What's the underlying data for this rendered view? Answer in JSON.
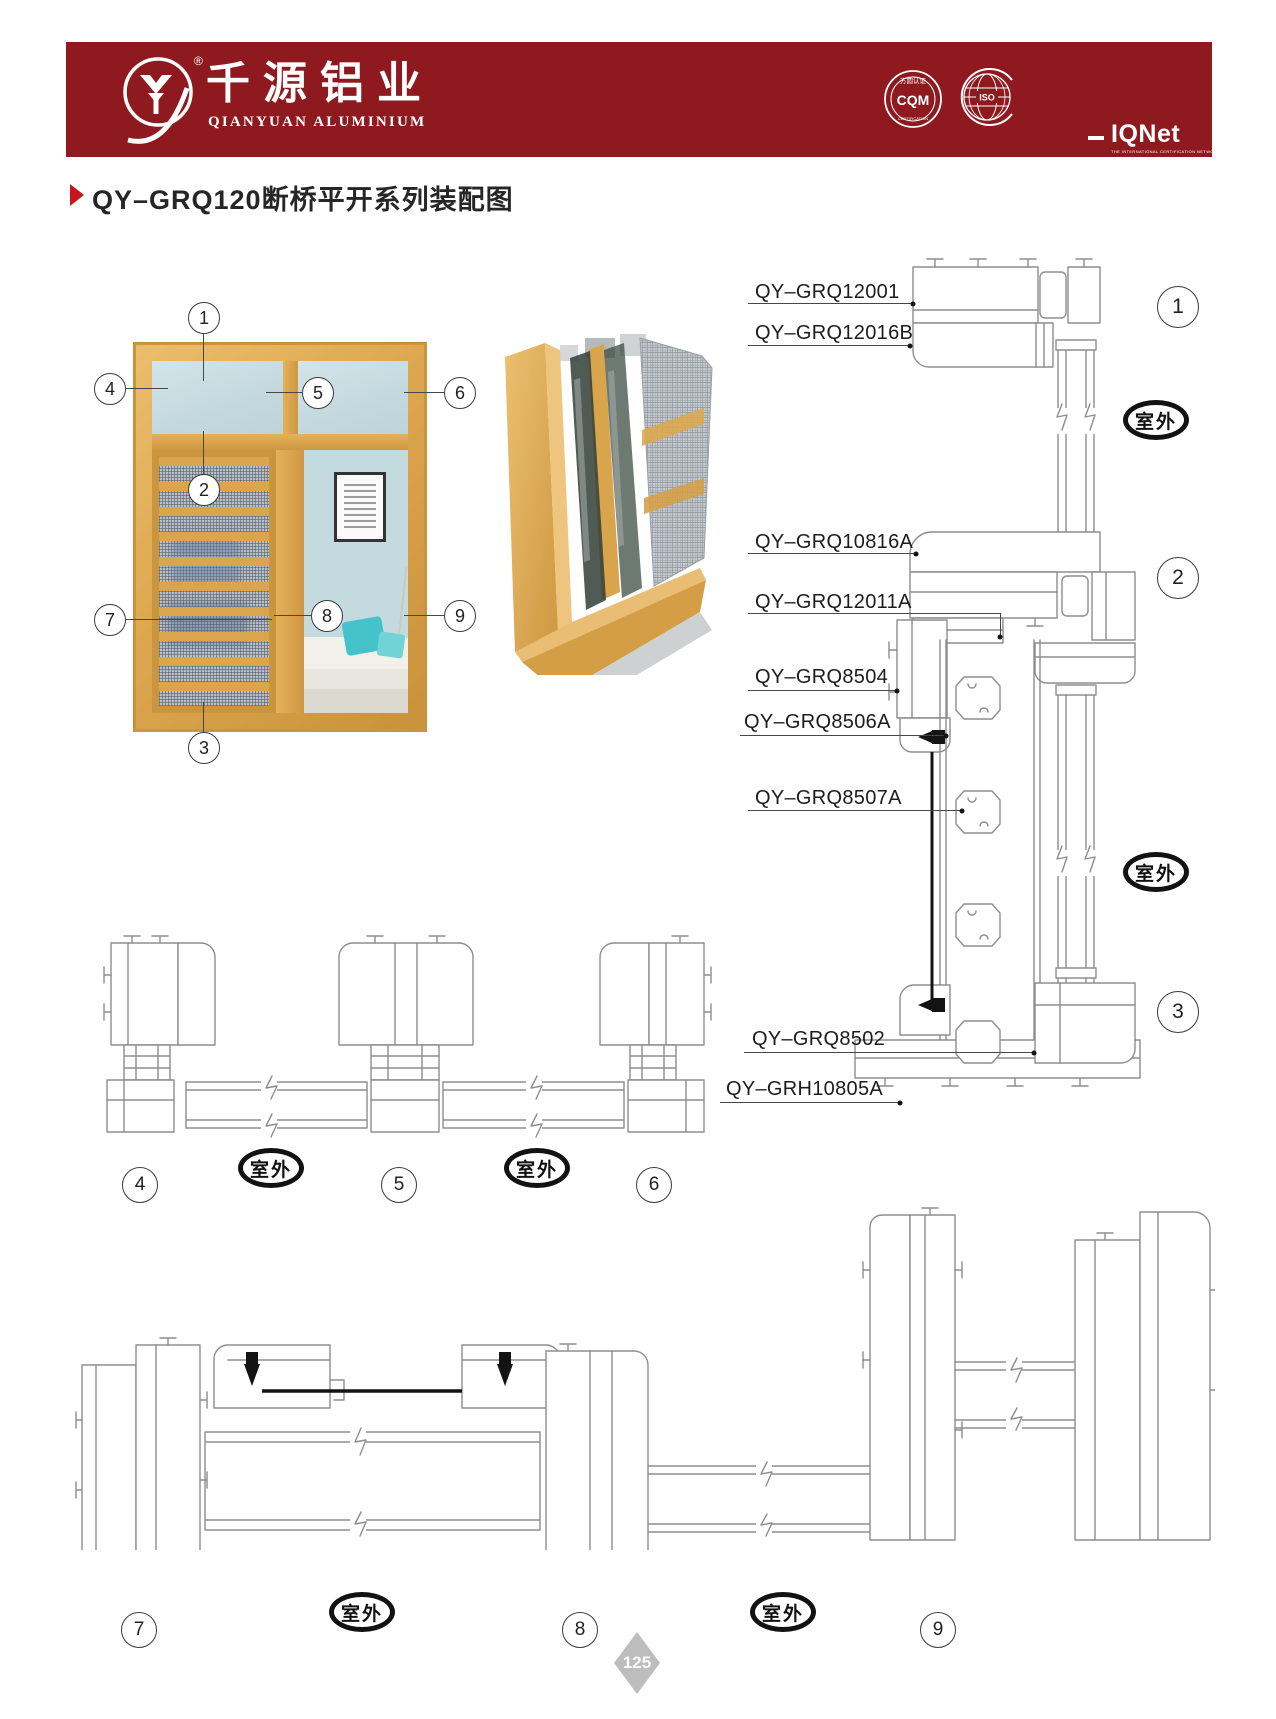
{
  "page": {
    "number": "125"
  },
  "header": {
    "bar_color": "#8E1A20",
    "brand_cn": "千源铝业",
    "brand_en": "QIANYUAN ALUMINIUM",
    "registered": "®",
    "badges": {
      "cqm_top": "方圆认证",
      "cqm_main": "CQM",
      "cqm_bottom": "CERTIFICATION",
      "iso_main": "ISO",
      "iqnet_main": "IQNet",
      "iqnet_sub": "THE INTERNATIONAL CERTIFICATION NETWORK",
      "dash": "—"
    }
  },
  "title": {
    "text": "QY–GRQ120断桥平开系列装配图",
    "marker_color": "#C8161E"
  },
  "outdoor": "室外",
  "window_callouts": [
    "1",
    "2",
    "3",
    "4",
    "5",
    "6",
    "7",
    "8",
    "9"
  ],
  "section_markers": {
    "vertical": [
      "1",
      "2",
      "3"
    ],
    "horizontal_top": [
      "4",
      "5",
      "6"
    ],
    "horizontal_bottom": [
      "7",
      "8",
      "9"
    ]
  },
  "part_labels": [
    "QY–GRQ12001",
    "QY–GRQ12016B",
    "QY–GRQ10816A",
    "QY–GRQ12011A",
    "QY–GRQ8504",
    "QY–GRQ8506A",
    "QY–GRQ8507A",
    "QY–GRQ8502",
    "QY–GRH10805A"
  ],
  "colors": {
    "wood": "#DCA551",
    "glass": "#C9DDE2",
    "drawing_line": "#8d8d8d",
    "dark": "#141414",
    "accent_red": "#8E1A20"
  }
}
